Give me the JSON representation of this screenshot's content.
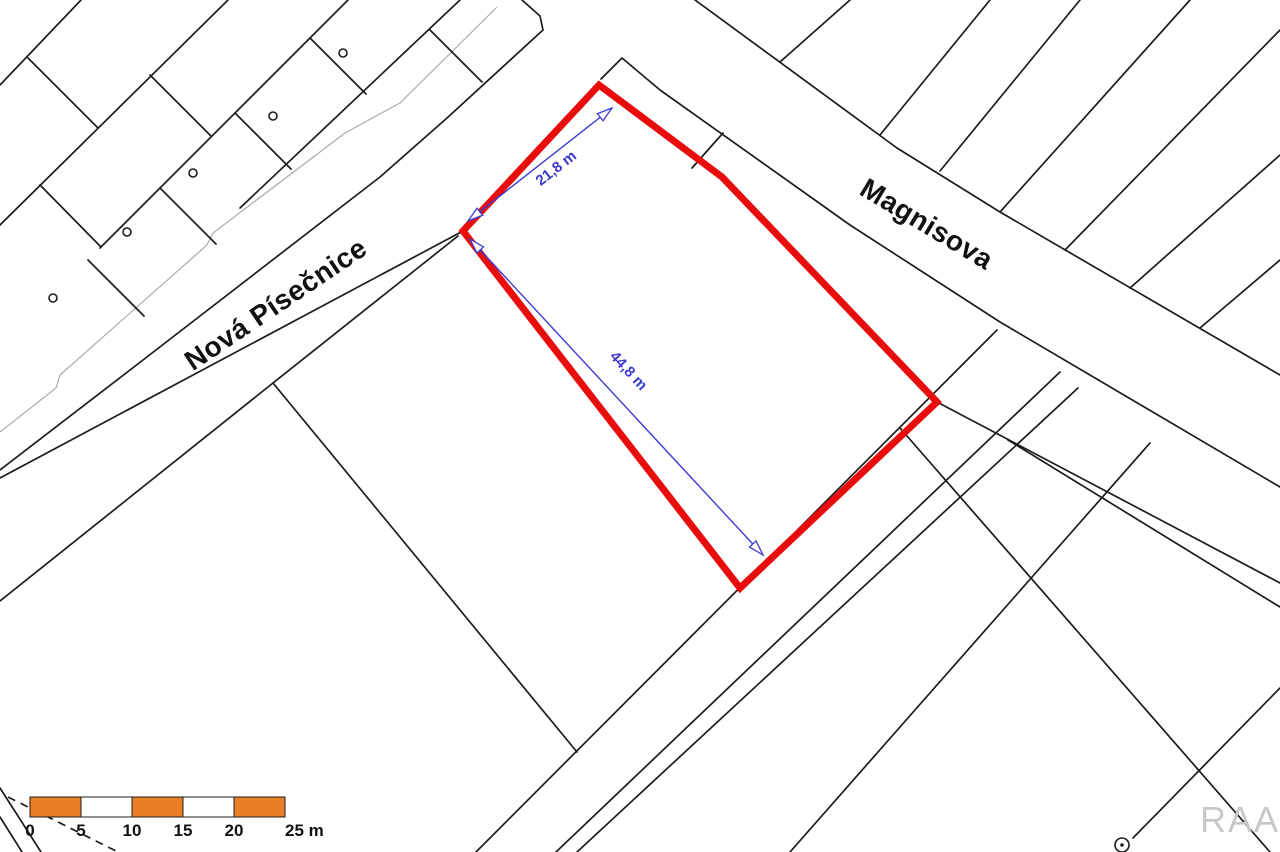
{
  "meta": {
    "width": 1280,
    "height": 852,
    "background": "#ffffff"
  },
  "colors": {
    "line": "#1c1c1c",
    "thin_line": "#ababab",
    "plot_outline": "#e80c0c",
    "dimension": "#3b3bd0",
    "scale_orange": "#e87f25",
    "scale_white": "#ffffff",
    "scale_border": "#1c1c1c",
    "text": "#111111",
    "watermark": "#c8c8c8"
  },
  "map": {
    "red_plot": {
      "points": [
        [
          599,
          85
        ],
        [
          722,
          177
        ],
        [
          937,
          402
        ],
        [
          740,
          588
        ],
        [
          463,
          231
        ]
      ],
      "stroke_width": 7
    },
    "black_lines": [
      {
        "points": [
          [
            81,
            0
          ],
          [
            0,
            85
          ]
        ]
      },
      {
        "points": [
          [
            228,
            0
          ],
          [
            0,
            225
          ]
        ]
      },
      {
        "points": [
          [
            348,
            0
          ],
          [
            100,
            248
          ]
        ]
      },
      {
        "points": [
          [
            460,
            0
          ],
          [
            240,
            208
          ]
        ]
      },
      {
        "points": [
          [
            28,
            58
          ],
          [
            98,
            128
          ]
        ]
      },
      {
        "points": [
          [
            150,
            75
          ],
          [
            211,
            136
          ]
        ]
      },
      {
        "points": [
          [
            40,
            185
          ],
          [
            101,
            247
          ]
        ]
      },
      {
        "points": [
          [
            310,
            38
          ],
          [
            366,
            94
          ]
        ]
      },
      {
        "points": [
          [
            235,
            113
          ],
          [
            291,
            169
          ]
        ]
      },
      {
        "points": [
          [
            160,
            188
          ],
          [
            216,
            244
          ]
        ]
      },
      {
        "points": [
          [
            88,
            260
          ],
          [
            144,
            316
          ]
        ]
      },
      {
        "points": [
          [
            430,
            30
          ],
          [
            482,
            82
          ]
        ]
      },
      {
        "points": [
          [
            522,
            0
          ],
          [
            540,
            16
          ],
          [
            543,
            30
          ],
          [
            447,
            118
          ],
          [
            380,
            177
          ],
          [
            143,
            360
          ],
          [
            0,
            470
          ]
        ]
      },
      {
        "points": [
          [
            463,
            231
          ],
          [
            0,
            478
          ]
        ]
      },
      {
        "points": [
          [
            458,
            236
          ],
          [
            273,
            383
          ],
          [
            0,
            601
          ]
        ]
      },
      {
        "points": [
          [
            273,
            383
          ],
          [
            577,
            752
          ]
        ]
      },
      {
        "points": [
          [
            601,
            79
          ],
          [
            622,
            58
          ],
          [
            660,
            90
          ],
          [
            850,
            225
          ],
          [
            1000,
            322
          ],
          [
            1280,
            487
          ]
        ]
      },
      {
        "points": [
          [
            695,
            0
          ],
          [
            897,
            148
          ],
          [
            1000,
            212
          ],
          [
            1280,
            375
          ]
        ]
      },
      {
        "points": [
          [
            780,
            62
          ],
          [
            850,
            0
          ]
        ]
      },
      {
        "points": [
          [
            880,
            135
          ],
          [
            990,
            0
          ]
        ]
      },
      {
        "points": [
          [
            940,
            171
          ],
          [
            1080,
            0
          ]
        ]
      },
      {
        "points": [
          [
            1000,
            212
          ],
          [
            1190,
            0
          ]
        ]
      },
      {
        "points": [
          [
            1065,
            250
          ],
          [
            1280,
            30
          ]
        ]
      },
      {
        "points": [
          [
            1130,
            288
          ],
          [
            1280,
            155
          ]
        ]
      },
      {
        "points": [
          [
            1200,
            328
          ],
          [
            1280,
            260
          ]
        ]
      },
      {
        "points": [
          [
            723,
            133
          ],
          [
            692,
            168
          ]
        ]
      },
      {
        "points": [
          [
            937,
            402
          ],
          [
            1280,
            583
          ]
        ]
      },
      {
        "points": [
          [
            1008,
            440
          ],
          [
            1280,
            607
          ]
        ]
      },
      {
        "points": [
          [
            997,
            330
          ],
          [
            476,
            852
          ]
        ]
      },
      {
        "points": [
          [
            1060,
            372
          ],
          [
            556,
            852
          ]
        ]
      },
      {
        "points": [
          [
            1078,
            388
          ],
          [
            577,
            852
          ]
        ]
      },
      {
        "points": [
          [
            1150,
            443
          ],
          [
            790,
            852
          ]
        ]
      },
      {
        "points": [
          [
            900,
            428
          ],
          [
            1270,
            852
          ]
        ]
      },
      {
        "points": [
          [
            1280,
            688
          ],
          [
            1133,
            838
          ]
        ]
      },
      {
        "points": [
          [
            0,
            788
          ],
          [
            41,
            852
          ]
        ]
      },
      {
        "points": [
          [
            0,
            817
          ],
          [
            22,
            852
          ]
        ]
      }
    ],
    "gray_lines": [
      {
        "points": [
          [
            497,
            7
          ],
          [
            400,
            103
          ],
          [
            345,
            133
          ],
          [
            213,
            233
          ],
          [
            207,
            245
          ],
          [
            60,
            375
          ],
          [
            56,
            388
          ],
          [
            0,
            432
          ]
        ]
      }
    ],
    "dashed_lines": [
      {
        "points": [
          [
            8,
            797
          ],
          [
            118,
            852
          ]
        ],
        "dash": "8,6"
      }
    ],
    "parcel_circles": [
      {
        "cx": 343,
        "cy": 53
      },
      {
        "cx": 273,
        "cy": 116
      },
      {
        "cx": 193,
        "cy": 173
      },
      {
        "cx": 127,
        "cy": 232
      },
      {
        "cx": 53,
        "cy": 298
      }
    ],
    "point_marker": {
      "cx": 1122,
      "cy": 845,
      "r": 7
    },
    "street_labels": [
      {
        "text": "Nová Písečnice",
        "x": 281,
        "y": 312,
        "angle": -34
      },
      {
        "text": "Magnisova",
        "x": 922,
        "y": 232,
        "angle": 31
      }
    ],
    "dimensions": [
      {
        "label": "21,8 m",
        "x1": 612,
        "y1": 108,
        "x2": 468,
        "y2": 221,
        "label_x": 559,
        "label_y": 172,
        "label_angle": -38
      },
      {
        "label": "44,8 m",
        "x1": 470,
        "y1": 239,
        "x2": 763,
        "y2": 555,
        "label_x": 625,
        "label_y": 374,
        "label_angle": 47
      }
    ]
  },
  "scale_bar": {
    "x": 30,
    "y": 797,
    "segment_width": 51,
    "height": 20,
    "segments": [
      "orange",
      "white",
      "orange",
      "white",
      "orange"
    ],
    "labels": [
      "0",
      "5",
      "10",
      "15",
      "20",
      "25 m"
    ],
    "label_y": 836
  },
  "watermark": {
    "text": "RAA",
    "x": 1240,
    "y": 832
  }
}
